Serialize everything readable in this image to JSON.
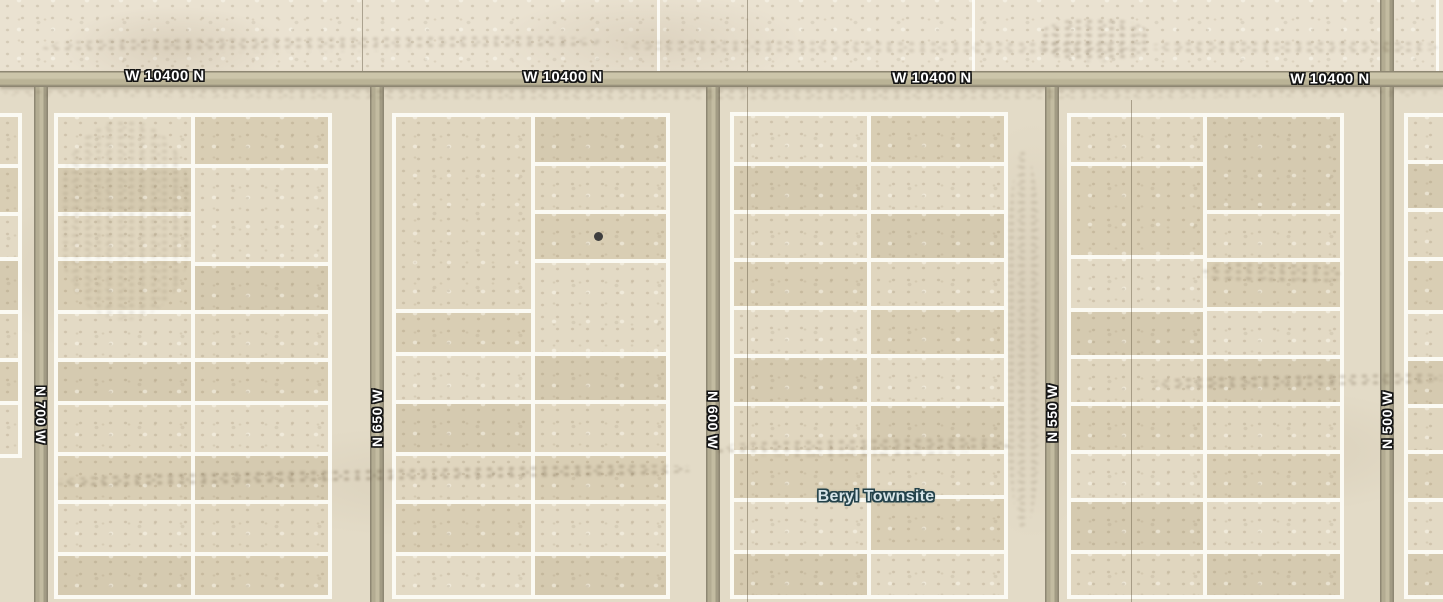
{
  "map": {
    "type": "satellite-plat-view",
    "width": 1443,
    "height": 602,
    "place_label": {
      "text": "Beryl Townsite",
      "x": 876,
      "y": 497
    },
    "horizontal_road": {
      "name": "W 10400 N",
      "y": 71,
      "height": 16,
      "labels": [
        {
          "text": "W 10400 N",
          "cx": 165,
          "cy": 76
        },
        {
          "text": "W 10400 N",
          "cx": 563,
          "cy": 77
        },
        {
          "text": "W 10400 N",
          "cx": 932,
          "cy": 78
        },
        {
          "text": "W 10400 N",
          "cx": 1330,
          "cy": 79
        }
      ]
    },
    "vertical_roads": [
      {
        "name": "N 700 W",
        "x": 34,
        "width": 14,
        "label_cy": 415,
        "label_dir": "down",
        "above_road": false
      },
      {
        "name": "N 650 W",
        "x": 370,
        "width": 14,
        "label_cy": 418,
        "label_dir": "up",
        "above_road": false
      },
      {
        "name": "N 600 W",
        "x": 706,
        "width": 14,
        "label_cy": 420,
        "label_dir": "down",
        "above_road": false
      },
      {
        "name": "N 550 W",
        "x": 1045,
        "width": 14,
        "label_cy": 413,
        "label_dir": "up",
        "above_road": false
      },
      {
        "name": "N 500 W",
        "x": 1380,
        "width": 14,
        "label_cy": 420,
        "label_dir": "up",
        "above_road": true
      }
    ],
    "section_lines": {
      "white_above_road_x": [
        658,
        973,
        1437
      ],
      "hairlines": [
        {
          "x": 362,
          "y1": 0,
          "y2": 71
        },
        {
          "x": 747,
          "y1": 0,
          "y2": 602
        },
        {
          "x": 1131,
          "y1": 100,
          "y2": 602
        }
      ]
    },
    "blocks": [
      {
        "x": -34,
        "y": 113,
        "w": 56,
        "h": 345,
        "vline_offset": null,
        "columns": [
          {
            "dividers": [
              164,
              212,
              257,
              310,
              358,
              401
            ]
          }
        ]
      },
      {
        "x": 54,
        "y": 113,
        "w": 278,
        "h": 486,
        "vline_offset": 137,
        "columns": [
          {
            "dividers": [
              164,
              212,
              257,
              310,
              358,
              401,
              452,
              500,
              552
            ]
          },
          {
            "dividers": [
              164,
              262,
              310,
              358,
              401,
              452,
              500,
              552
            ]
          }
        ]
      },
      {
        "x": 392,
        "y": 113,
        "w": 278,
        "h": 486,
        "vline_offset": 139,
        "columns": [
          {
            "dividers": [
              309,
              352,
              400,
              452,
              500,
              552
            ]
          },
          {
            "dividers": [
              162,
              210,
              259,
              352,
              400,
              452,
              500,
              552
            ]
          }
        ]
      },
      {
        "x": 730,
        "y": 112,
        "w": 278,
        "h": 487,
        "vline_offset": 137,
        "columns": [
          {
            "dividers": [
              162,
              210,
              258,
              306,
              354,
              402,
              450,
              498,
              550
            ]
          },
          {
            "dividers": [
              162,
              210,
              258,
              306,
              354,
              402,
              450,
              495,
              550
            ]
          }
        ]
      },
      {
        "x": 1067,
        "y": 113,
        "w": 277,
        "h": 486,
        "vline_offset": 136,
        "columns": [
          {
            "dividers": [
              162,
              255,
              308,
              355,
              402,
              450,
              498,
              550
            ]
          },
          {
            "dividers": [
              210,
              258,
              307,
              355,
              402,
              450,
              498,
              550
            ]
          }
        ]
      },
      {
        "x": 1404,
        "y": 113,
        "w": 80,
        "h": 486,
        "vline_offset": null,
        "columns": [
          {
            "dividers": [
              160,
              208,
              257,
              310,
              357,
              404,
              450,
              498,
              550
            ]
          }
        ]
      }
    ],
    "marker_dot": {
      "x": 598,
      "y": 236,
      "diameter": 9,
      "color": "#3f3f3f"
    },
    "smudges": [
      {
        "x": 40,
        "y": 36,
        "w": 560,
        "h": 16,
        "rot": -0.5,
        "op": 0.35
      },
      {
        "x": 620,
        "y": 40,
        "w": 520,
        "h": 14,
        "rot": 0.3,
        "op": 0.3
      },
      {
        "x": 1040,
        "y": 18,
        "w": 110,
        "h": 44,
        "rot": 0,
        "op": 0.4
      },
      {
        "x": 1150,
        "y": 40,
        "w": 290,
        "h": 14,
        "rot": 0,
        "op": 0.35
      },
      {
        "x": 0,
        "y": 88,
        "w": 1443,
        "h": 11,
        "rot": 0,
        "op": 0.28
      },
      {
        "x": 55,
        "y": 468,
        "w": 640,
        "h": 15,
        "rot": -1.2,
        "op": 0.5
      },
      {
        "x": 715,
        "y": 438,
        "w": 300,
        "h": 18,
        "rot": -1.0,
        "op": 0.38
      },
      {
        "x": 1150,
        "y": 374,
        "w": 295,
        "h": 14,
        "rot": -1.2,
        "op": 0.45
      },
      {
        "x": 1200,
        "y": 262,
        "w": 145,
        "h": 22,
        "rot": 1.0,
        "op": 0.35
      },
      {
        "x": 1006,
        "y": 150,
        "w": 36,
        "h": 380,
        "rot": 0,
        "op": 0.25
      },
      {
        "x": 60,
        "y": 120,
        "w": 130,
        "h": 200,
        "rot": 0,
        "op": 0.22
      }
    ],
    "colors": {
      "terrain_base": "#e3dbc7",
      "terrain_north": "#eae2d1",
      "lot_tints": [
        "#e0d6bf",
        "#d9ceb4",
        "#e3dac5",
        "#d5cab0"
      ],
      "parcel_line": "#fbfaf3",
      "road_fill": "#beb79d",
      "road_edge": "#8e8773",
      "road_label_fill": "#ffffff",
      "road_label_halo": "#141414",
      "place_label_fill": "#d8e5e9",
      "place_label_halo": "#24424a",
      "marker": "#3f3f3f"
    }
  }
}
